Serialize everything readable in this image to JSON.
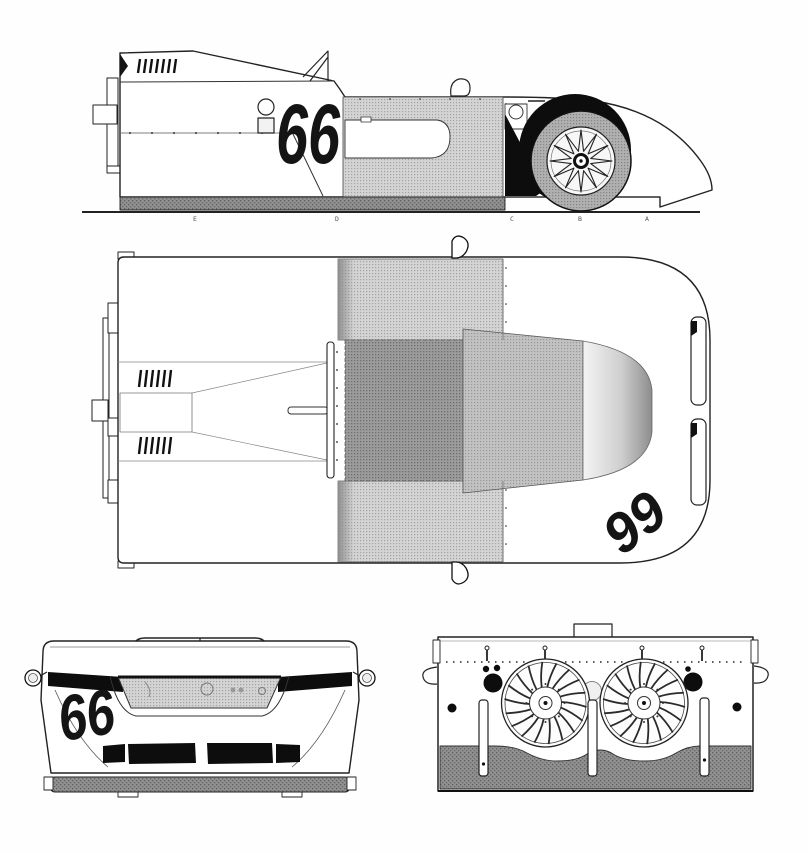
{
  "drawing": {
    "subject": "race-car-blueprint-four-views",
    "racing_number": {
      "side": "66",
      "top": "66",
      "front": "66"
    },
    "ground_labels": [
      "E",
      "D",
      "C",
      "B",
      "A"
    ]
  },
  "colors": {
    "background": "#fefefe",
    "line": "#222222",
    "number_fill": "#141414",
    "mesh_light": "#d4d4d4",
    "mesh_mid": "#b0b0b0",
    "mesh_dark": "#9c9c9c",
    "skirt_gray": "#909090",
    "black_fill": "#0d0d0d",
    "canopy_light": "#f4f4f4",
    "canopy_dark": "#8d8d8d"
  }
}
